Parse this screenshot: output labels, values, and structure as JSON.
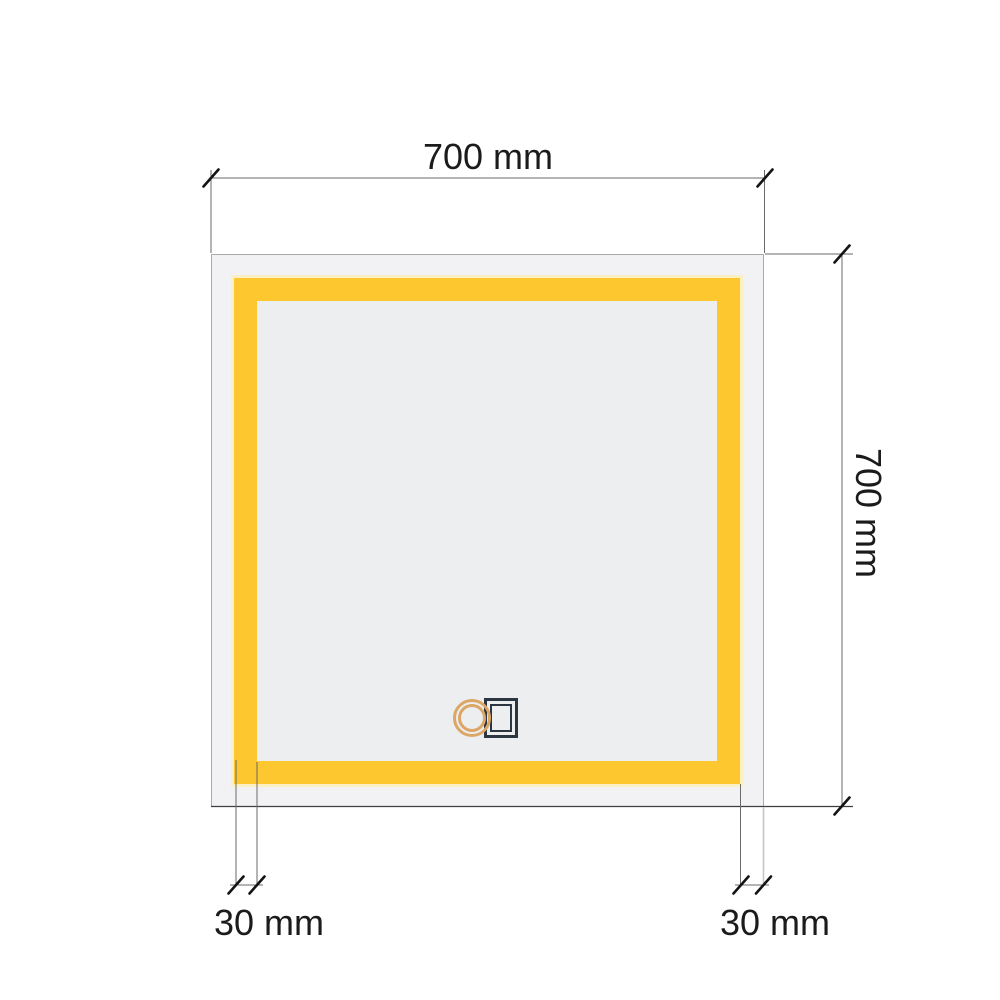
{
  "diagram": {
    "type": "product-dimension-drawing",
    "subject": "square LED bathroom mirror, front view, with touch sensor",
    "labels": {
      "top_width": "700 mm",
      "right_height": "700 mm",
      "bottom_left_offset": "30 mm",
      "bottom_right_offset": "30 mm"
    },
    "icons": {
      "touch_sensor": "double-ring finger touch symbol over double-outline switch square"
    },
    "colors": {
      "background": "#FFFFFF",
      "led_strip": "#FCC72F",
      "led_glow": "#FBF0C4",
      "mirror_face": "#F2F2F4",
      "inner_face": "#EDEEF0",
      "dim_line": "#6A6A6A",
      "edge_line": "#3E3E3E",
      "light_ext_line": "#C6C6C8",
      "tick": "#141414",
      "text": "#1B1B1B",
      "sensor_ring": "#DCA766",
      "sensor_square": "#2B3642",
      "mirror_border": "#A8ABAD"
    }
  }
}
